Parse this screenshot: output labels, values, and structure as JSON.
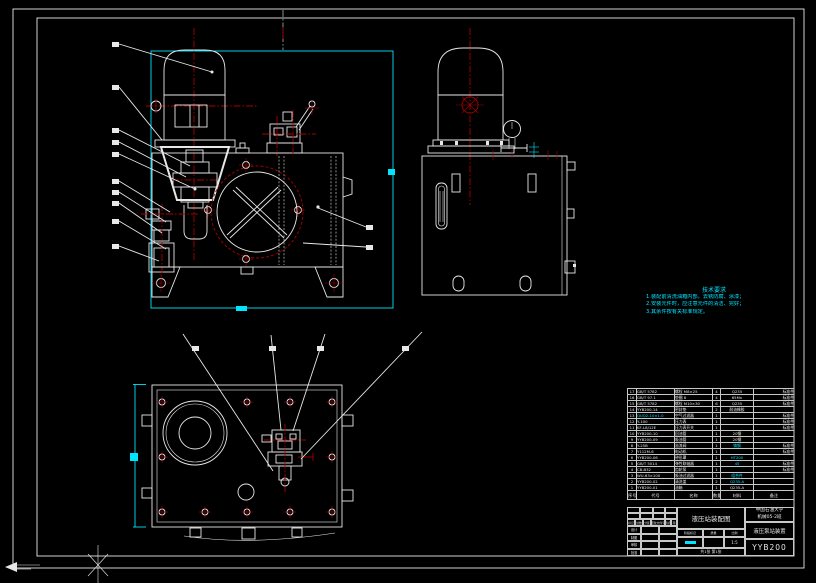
{
  "page": {
    "background": "#000000",
    "line_color": "#e8e8e8",
    "accent_red": "#a40000",
    "accent_cyan": "#00e5ff"
  },
  "tech_requirements": {
    "title": "技术要求",
    "items": [
      "1.装配前清洗油箱内部，去锈防腐、涂漆；",
      "2.安装元件时，应注意元件的清洁、完好；",
      "3.其余件按有关标准规定。"
    ]
  },
  "bom": {
    "headers": [
      "序号",
      "代号",
      "名称",
      "数量",
      "材料",
      "备注"
    ],
    "rows": [
      {
        "no": "17",
        "code": "GB/T 5782",
        "name": "螺栓 M8×25",
        "qty": "4",
        "mat": "Q235",
        "note": "标准件"
      },
      {
        "no": "16",
        "code": "GB/T 97.1",
        "name": "垫圈 8",
        "qty": "4",
        "mat": "65Mn",
        "note": "标准件"
      },
      {
        "no": "15",
        "code": "GB/T 5782",
        "name": "螺栓 M10×30",
        "qty": "6",
        "mat": "Q235",
        "note": "标准件"
      },
      {
        "no": "14",
        "code": "YYB200-14",
        "name": "密封垫",
        "qty": "2",
        "mat": "耐油橡胶",
        "note": ""
      },
      {
        "no": "13",
        "code": "QUQ2-10×1.0",
        "name": "空气过滤器",
        "qty": "1",
        "mat": "",
        "note": "标准件",
        "hl": "code"
      },
      {
        "no": "12",
        "code": "Y-100",
        "name": "压力表",
        "qty": "1",
        "mat": "",
        "note": "标准件"
      },
      {
        "no": "11",
        "code": "KF-L8/12E",
        "name": "压力表开关",
        "qty": "1",
        "mat": "",
        "note": "标准件"
      },
      {
        "no": "10",
        "code": "YYB200-10",
        "name": "回油管",
        "qty": "1",
        "mat": "20钢",
        "note": ""
      },
      {
        "no": "9",
        "code": "YYB200-09",
        "name": "吸油管",
        "qty": "1",
        "mat": "20钢",
        "note": ""
      },
      {
        "no": "8",
        "code": "Y-25B",
        "name": "溢流阀",
        "qty": "1",
        "mat": "铸钢",
        "note": "标准件",
        "hl": "mat"
      },
      {
        "no": "7",
        "code": "Y112M-6",
        "name": "电动机",
        "qty": "1",
        "mat": "",
        "note": "标准件"
      },
      {
        "no": "6",
        "code": "YYB200-06",
        "name": "钟形罩",
        "qty": "1",
        "mat": "HT200",
        "note": "",
        "hl": "mat"
      },
      {
        "no": "5",
        "code": "GB/T 5014",
        "name": "弹性联轴器",
        "qty": "1",
        "mat": "45",
        "note": "标准件",
        "hl": "mat"
      },
      {
        "no": "4",
        "code": "CB-B32",
        "name": "齿轮泵",
        "qty": "1",
        "mat": "",
        "note": "标准件"
      },
      {
        "no": "3",
        "code": "WU-63×100",
        "name": "吸油过滤器",
        "qty": "1",
        "mat": "组合件",
        "note": "",
        "hl": "mat"
      },
      {
        "no": "2",
        "code": "YYB200-02",
        "name": "清洗盖",
        "qty": "2",
        "mat": "Q235-A",
        "note": "",
        "hl": "mat"
      },
      {
        "no": "1",
        "code": "YYB200-01",
        "name": "油箱",
        "qty": "1",
        "mat": "Q235-A",
        "note": ""
      }
    ]
  },
  "title_block": {
    "change_row": [
      "标记",
      "处数",
      "分区",
      "更改文件号",
      "签名",
      "年月日"
    ],
    "sign_rows": [
      {
        "label": "设计",
        "name": "",
        "date": ""
      },
      {
        "label": "制图",
        "name": "",
        "date": ""
      },
      {
        "label": "审核",
        "name": "",
        "date": ""
      },
      {
        "label": "批准",
        "name": "",
        "date": ""
      }
    ],
    "drawing_title": "液压站装配图",
    "stage_label": "阶段标记",
    "weight_label": "质量",
    "scale_label": "比例",
    "scale_value": "1:5",
    "sheets": "共1张 第1张",
    "org_line1": "中国石油大学",
    "org_line2": "机械05-2班",
    "product_name": "液压泵站装置",
    "drawing_no": "YYB200"
  }
}
